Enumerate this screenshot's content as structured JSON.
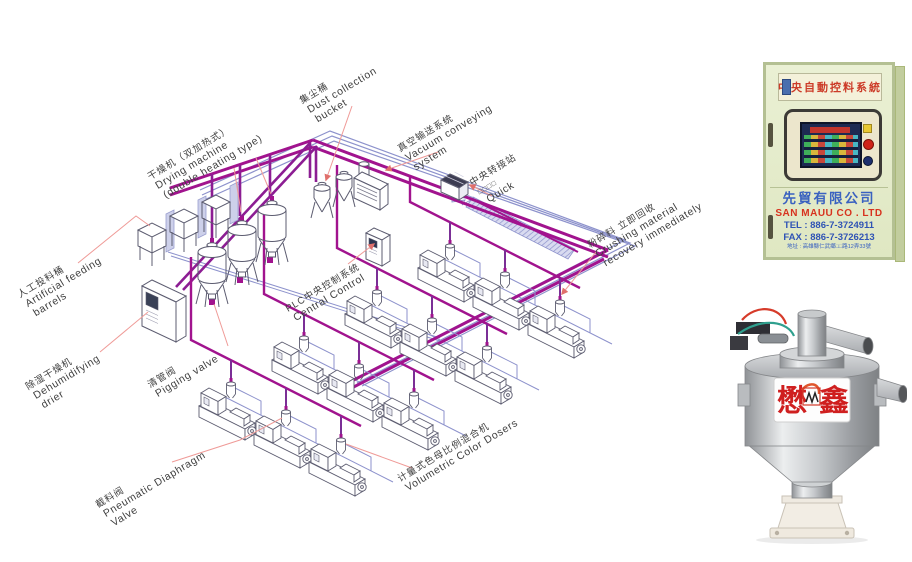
{
  "diagram": {
    "labels": {
      "artificial_feeding": {
        "zh": "人工投料桶",
        "en1": "Artificial feeding",
        "en2": "barrels"
      },
      "drying_machine": {
        "zh": "干燥机（双加热式）",
        "en1": "Drying machine",
        "en2": "(double heating type)"
      },
      "dust_collection": {
        "zh": "集尘桶",
        "en1": "Dust collection",
        "en2": "bucket"
      },
      "vacuum_conveying": {
        "zh": "真空输送系统",
        "en1": "Vacuum conveying",
        "en2": "system"
      },
      "transfer_station": {
        "zh": "中央转接站",
        "en1": "□□□□",
        "en2": "Quick"
      },
      "crushing_recovery": {
        "zh": "粉碎料 立即回收",
        "en1": "Crushing material",
        "en2": "recovery immediately"
      },
      "plc_control": {
        "zh": "PLC中央控制系统",
        "en1": "Central Control"
      },
      "dehumidifying": {
        "zh": "除湿干燥机",
        "en1": "Dehumidifying",
        "en2": "drier"
      },
      "pigging_valve": {
        "zh": "清管阀",
        "en1": "Pigging valve"
      },
      "pneumatic_valve": {
        "zh": "截料阀",
        "en1": "Pneumatic Diaphragm",
        "en2": "Valve"
      },
      "volumetric_doser": {
        "zh": "计量式色母比例混合机",
        "en1": "Volumetric Color Dosers"
      }
    },
    "colors": {
      "pipe_magenta": "#a1138e",
      "pipe_purple": "#7b2f96",
      "pipe_blue": "#8d92cc",
      "leader_red": "#ef9a97",
      "outline": "#5c5c70"
    }
  },
  "cabinet_photo": {
    "banner": "中央自動控料系統",
    "company_zh": "先貿有限公司",
    "company_en": "SAN MAUU CO . LTD",
    "tel": "TEL : 886-7-3724911",
    "fax": "FAX : 886-7-3726213",
    "address": "地址 : 高雄縣仁武鄉□□路12弄33號"
  },
  "hopper_photo": {
    "brand_left": "懋",
    "brand_right": "鑫"
  }
}
